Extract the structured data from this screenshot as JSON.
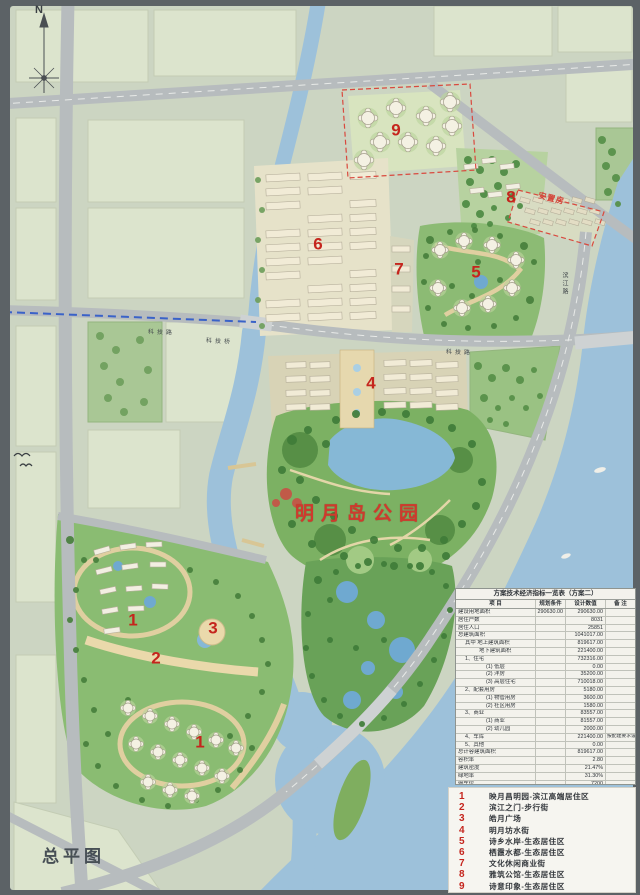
{
  "map": {
    "plan_title": "总平图",
    "compass_n": "N",
    "park_label": "明月岛公园",
    "red_note": "安置房",
    "roads": {
      "keji_left": "科技路",
      "keji_bridge": "科技桥",
      "keji_right": "科技路",
      "binjiang": "滨江路"
    },
    "zone_markers": [
      {
        "num": "9"
      },
      {
        "num": "8"
      },
      {
        "num": "6"
      },
      {
        "num": "7"
      },
      {
        "num": "5"
      },
      {
        "num": "4"
      },
      {
        "num": "1"
      },
      {
        "num": "2"
      },
      {
        "num": "3"
      },
      {
        "num": "1"
      }
    ],
    "colors": {
      "paper": "#ccd5c2",
      "water": "#9dc1da",
      "road": "#b7bcbe",
      "park_green": "#7cb163",
      "zone_number_red": "#c5251d",
      "boundary_dash_red": "#d9493e",
      "metro_dash_blue": "#3a62c8"
    }
  },
  "legend": {
    "items": [
      {
        "num": "1",
        "label": "映月昌明园-滨江高端居住区"
      },
      {
        "num": "2",
        "label": "滨江之门-步行街"
      },
      {
        "num": "3",
        "label": "皓月广场"
      },
      {
        "num": "4",
        "label": "明月坊水街"
      },
      {
        "num": "5",
        "label": "诗乡水岸-生态居住区"
      },
      {
        "num": "6",
        "label": "栖霞水都-生态居住区"
      },
      {
        "num": "7",
        "label": "文化休闲商业街"
      },
      {
        "num": "8",
        "label": "雅筑公馆-生态居住区"
      },
      {
        "num": "9",
        "label": "诗意印象-生态居住区"
      }
    ]
  },
  "table": {
    "title": "方案技术经济指标一览表（方案二）",
    "headers": [
      "项  目",
      "规划条件",
      "设计数值",
      "备 注"
    ],
    "rows": [
      {
        "item": "建设用地面积",
        "cond": "290630.00",
        "value": "290630.00",
        "note": "",
        "ind": 0
      },
      {
        "item": "居住户数",
        "cond": "",
        "value": "8031",
        "note": "",
        "ind": 0
      },
      {
        "item": "居住人口",
        "cond": "",
        "value": "25851",
        "note": "",
        "ind": 0
      },
      {
        "item": "总建筑面积",
        "cond": "",
        "value": "1041017.00",
        "note": "",
        "ind": 0
      },
      {
        "item": "其中  地上建筑面积",
        "cond": "",
        "value": "819617.00",
        "note": "",
        "ind": 1
      },
      {
        "item": "地下建筑面积",
        "cond": "",
        "value": "221400.00",
        "note": "",
        "ind": 3
      },
      {
        "item": "1、住宅",
        "cond": "",
        "value": "732316.00",
        "note": "",
        "ind": 1
      },
      {
        "item": "(1) 低层",
        "cond": "",
        "value": "0.00",
        "note": "",
        "ind": 4
      },
      {
        "item": "(2) 洋房",
        "cond": "",
        "value": "35200.00",
        "note": "",
        "ind": 4
      },
      {
        "item": "(3) 高层住宅",
        "cond": "",
        "value": "710018.00",
        "note": "",
        "ind": 4
      },
      {
        "item": "2、配套用房",
        "cond": "",
        "value": "5180.00",
        "note": "",
        "ind": 1
      },
      {
        "item": "(1) 物管用房",
        "cond": "",
        "value": "3600.00",
        "note": "",
        "ind": 4
      },
      {
        "item": "(2) 社区用房",
        "cond": "",
        "value": "1580.00",
        "note": "",
        "ind": 4
      },
      {
        "item": "3、商业",
        "cond": "",
        "value": "83557.00",
        "note": "",
        "ind": 1
      },
      {
        "item": "(1) 商业",
        "cond": "",
        "value": "81557.00",
        "note": "",
        "ind": 4
      },
      {
        "item": "(2) 幼儿园",
        "cond": "",
        "value": "2000.00",
        "note": "",
        "ind": 4
      },
      {
        "item": "4、车库",
        "cond": "",
        "value": "221400.00",
        "note": "按配建要求设置",
        "ind": 1
      },
      {
        "item": "5、其他",
        "cond": "",
        "value": "0.00",
        "note": "",
        "ind": 1
      },
      {
        "item": "总计容建筑面积",
        "cond": "",
        "value": "819617.00",
        "note": "",
        "ind": 0
      },
      {
        "item": "容积率",
        "cond": "",
        "value": "2.80",
        "note": "",
        "ind": 0
      },
      {
        "item": "建筑密度",
        "cond": "",
        "value": "21.47%",
        "note": "",
        "ind": 0
      },
      {
        "item": "绿地率",
        "cond": "",
        "value": "31.30%",
        "note": "",
        "ind": 0
      },
      {
        "item": "停车位",
        "cond": "",
        "value": "7200",
        "note": "",
        "ind": 0
      },
      {
        "item": "其中  地面车位",
        "cond": "",
        "value": "100",
        "note": "",
        "ind": 1
      },
      {
        "item": "地下车位",
        "cond": "",
        "value": "7100",
        "note": "",
        "ind": 3
      },
      {
        "item": "建筑高度（限高）",
        "cond": "",
        "value": "98.8米",
        "note": "",
        "ind": 0
      }
    ]
  }
}
